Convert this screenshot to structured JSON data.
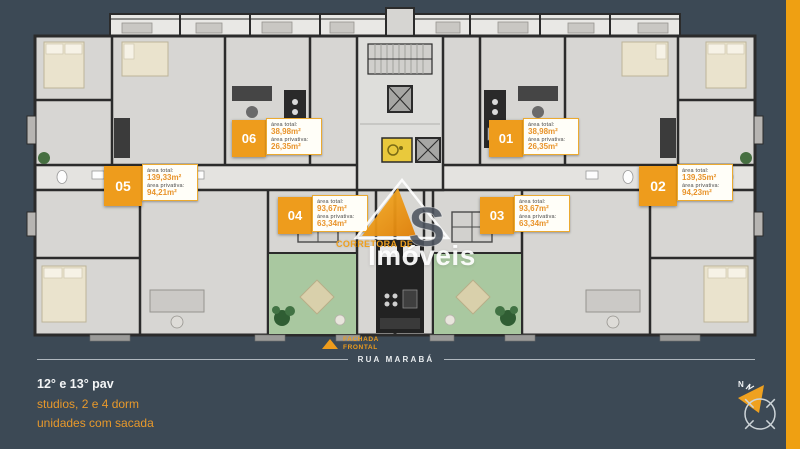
{
  "page": {
    "bg_color": "#3C4955",
    "accent_color": "#EFA012"
  },
  "watermark": {
    "monogram_s": "S",
    "line1": "CORRETORA DE",
    "line2": "Imóveis"
  },
  "badges": {
    "area_total_label": "área total:",
    "area_priv_label": "área privativa:",
    "units": [
      {
        "id": "06",
        "total": "38,98m²",
        "priv": "26,35m²"
      },
      {
        "id": "01",
        "total": "38,98m²",
        "priv": "26,35m²"
      },
      {
        "id": "05",
        "total": "139,33m²",
        "priv": "94,21m²"
      },
      {
        "id": "02",
        "total": "139,35m²",
        "priv": "94,23m²"
      },
      {
        "id": "04",
        "total": "93,67m²",
        "priv": "63,34m²"
      },
      {
        "id": "03",
        "total": "93,67m²",
        "priv": "63,34m²"
      }
    ]
  },
  "facade": {
    "line1": "FACHADA",
    "line2": "FRONTAL"
  },
  "street": {
    "name": "RUA MARABÁ"
  },
  "caption": {
    "line1": "12° e 13° pav",
    "line2": "studios, 2 e 4 dorm",
    "line3": "unidades com sacada"
  },
  "compass": {
    "north": "N"
  }
}
